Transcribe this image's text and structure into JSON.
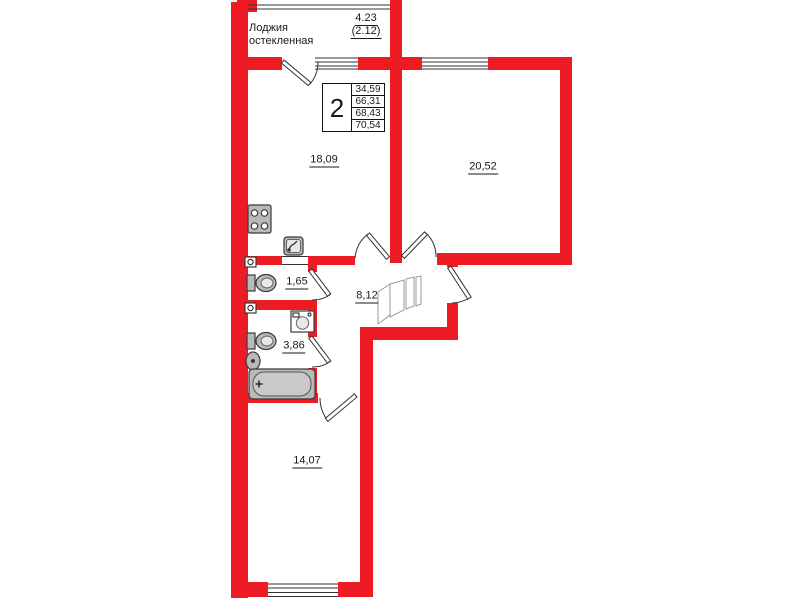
{
  "loggia": {
    "label_line1": "Лоджия",
    "label_line2": "остекленная",
    "dimension": "4.23",
    "dimension_secondary": "(2.12)"
  },
  "summary_box": {
    "room_count": "2",
    "areas": [
      "34,59",
      "66,31",
      "68,43",
      "70,54"
    ]
  },
  "rooms": [
    {
      "name": "kitchen-living-room",
      "area": "18,09"
    },
    {
      "name": "room-right",
      "area": "20,52"
    },
    {
      "name": "wc",
      "area": "1,65"
    },
    {
      "name": "bathroom",
      "area": "3,86"
    },
    {
      "name": "hallway",
      "area": "8,12"
    },
    {
      "name": "bedroom",
      "area": "14,07"
    }
  ],
  "icons": [
    "stove-icon",
    "kitchen-sink-icon",
    "toilet-icon",
    "washing-machine-icon",
    "bath-sink-icon",
    "bathtub-icon",
    "vent-icon",
    "wardrobe-sketch",
    "door-swing-icon",
    "window-icon"
  ],
  "colors": {
    "wall_red": "#ED1C24",
    "line": "#333333",
    "fixture_fill": "#b9b9b9"
  }
}
